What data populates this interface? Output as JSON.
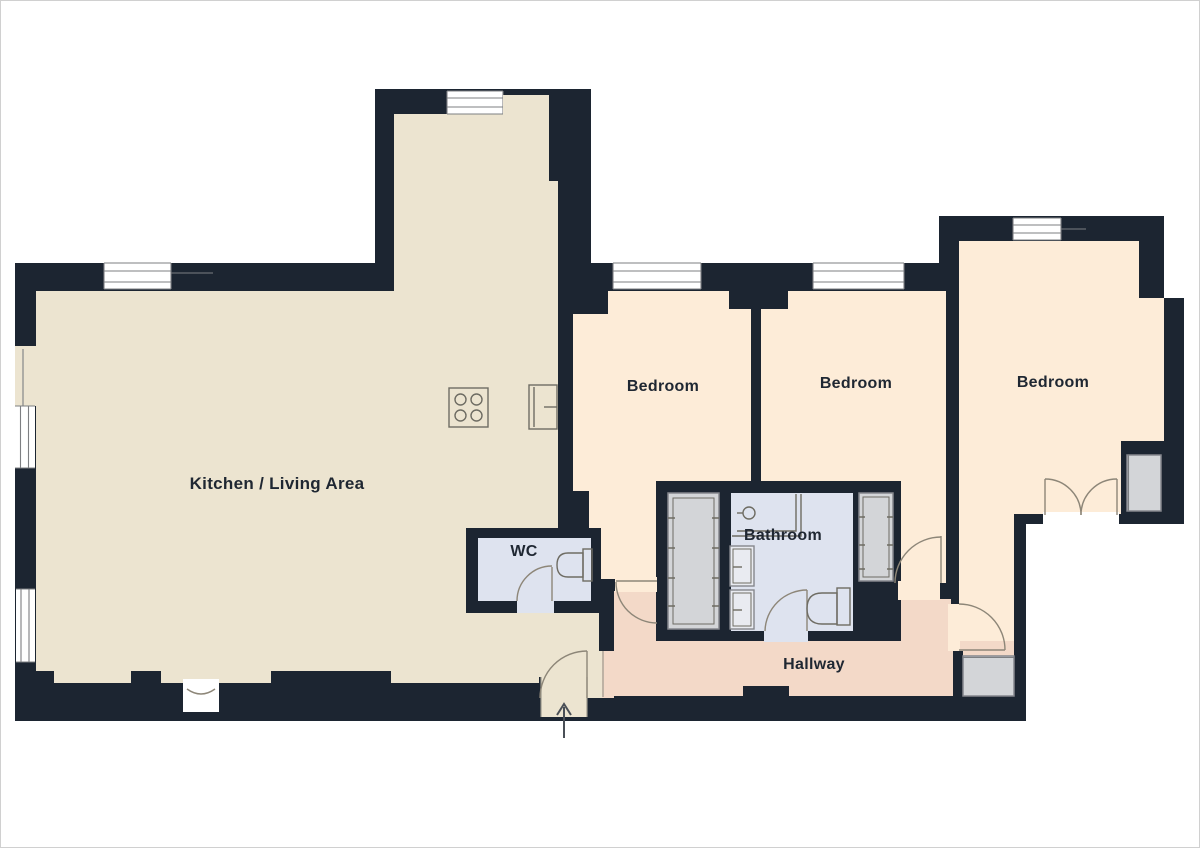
{
  "floorplan": {
    "title": "Apartment floor plan",
    "rooms": {
      "kitchen_living": {
        "label": "Kitchen / Living Area"
      },
      "wc": {
        "label": "WC"
      },
      "bathroom": {
        "label": "Bathroom"
      },
      "hallway": {
        "label": "Hallway"
      },
      "bedroom_left": {
        "label": "Bedroom"
      },
      "bedroom_middle": {
        "label": "Bedroom"
      },
      "bedroom_right": {
        "label": "Bedroom"
      }
    },
    "icons": [
      "window-icon",
      "door-swing-icon",
      "double-door-icon",
      "stove-icon",
      "kitchen-sink-icon",
      "shower-icon",
      "toilet-icon",
      "wardrobe-icon",
      "closet-icon",
      "entry-arrow-icon",
      "fireplace-niche-icon"
    ],
    "colors": {
      "wall": "#1c2531",
      "kitchen": "#ece4d0",
      "bedroom": "#fdecd8",
      "hallway": "#f3d9c8",
      "wet": "#dee3ef",
      "closet": "#d3d5d8",
      "closet_border": "#85878d",
      "fixture": "#6e6c63",
      "cabinet": "#e9ebf1",
      "arc": "#8d8678",
      "window_line": "#7d7f82",
      "threshold": "#9b988c",
      "text": "#1f2732",
      "outside": "#ffffff",
      "page_border": "#d0d0d0"
    }
  }
}
